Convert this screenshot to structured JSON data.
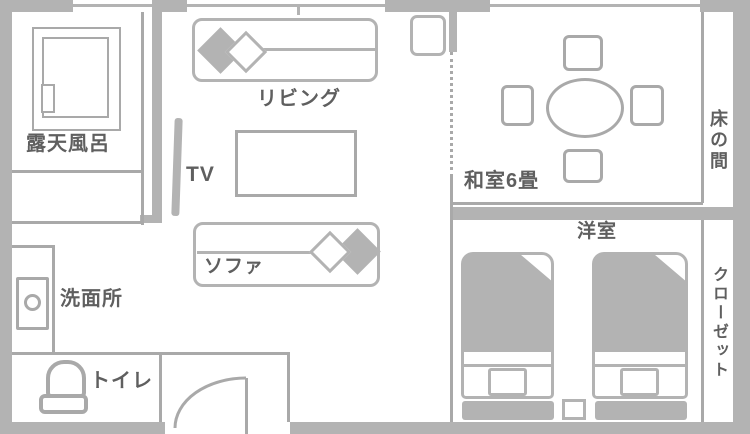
{
  "colors": {
    "wall": "#b3b3b3",
    "line": "#a9a9a9",
    "text": "#5f5f5f",
    "bg": "#ffffff"
  },
  "labels": {
    "bath": "露天風呂",
    "living": "リビング",
    "tv": "TV",
    "sofa": "ソファ",
    "washroom": "洗面所",
    "toilet": "トイレ",
    "tatami": "和室6畳",
    "tokonoma": "床の間",
    "western": "洋室",
    "closet": "クローゼット"
  }
}
